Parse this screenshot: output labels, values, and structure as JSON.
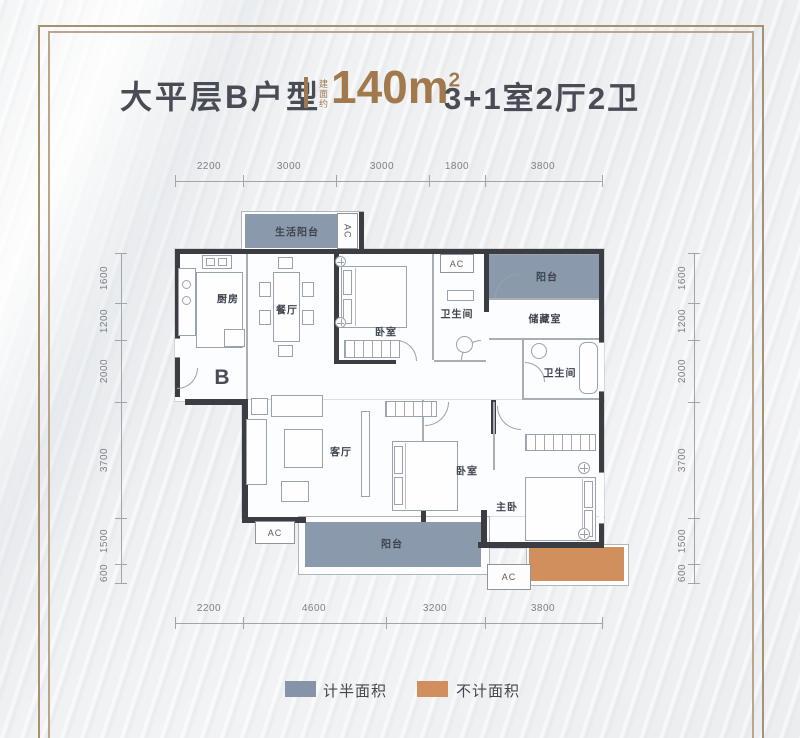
{
  "header": {
    "title": "大平层B户型",
    "area_prefix": "建面约",
    "area_value": "140m",
    "area_sup": "2",
    "layout": "3+1室2厅2卫"
  },
  "plan": {
    "marker": "B",
    "ac": "AC",
    "rooms": {
      "living_balcony": "生活阳台",
      "kitchen": "厨房",
      "dining": "餐厅",
      "bedroom1": "卧室",
      "bath1": "卫生间",
      "balcony_top": "阳台",
      "storage": "储藏室",
      "bath2": "卫生间",
      "living": "客厅",
      "bedroom2": "卧室",
      "master": "主卧",
      "balcony_bottom": "阳台"
    }
  },
  "dimensions": {
    "top": [
      "2200",
      "3000",
      "3000",
      "1800",
      "3800"
    ],
    "bottom": [
      "2200",
      "4600",
      "3200",
      "3800"
    ],
    "left": [
      "1600",
      "1200",
      "2000",
      "3700",
      "1500",
      "600"
    ],
    "right": [
      "1600",
      "1200",
      "2000",
      "3700",
      "1500",
      "600"
    ]
  },
  "legend": {
    "half_area": {
      "label": "计半面积",
      "color": "#8594a8"
    },
    "excluded_area": {
      "label": "不计面积",
      "color": "#d18f5e"
    }
  },
  "colors": {
    "accent_brown": "#a1794c",
    "frame_gold": "#a8916f",
    "wall_dark": "#3c3d43",
    "half_area_fill": "#8594a8",
    "excluded_area_fill": "#d18f5e"
  }
}
